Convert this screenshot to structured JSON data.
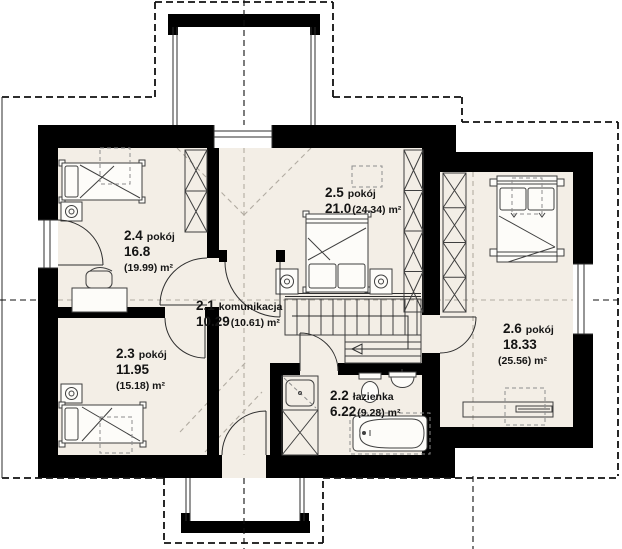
{
  "plan": {
    "floor_name": "",
    "unit": "m²"
  },
  "rooms": [
    {
      "id": "2.1",
      "name": "komunikacja",
      "area": "10.29",
      "area_gross": "(10.61) m²"
    },
    {
      "id": "2.2",
      "name": "łazienka",
      "area": "6.22",
      "area_gross": "(9.28) m²"
    },
    {
      "id": "2.3",
      "name": "pokój",
      "area": "11.95",
      "area_gross": "(15.18) m²"
    },
    {
      "id": "2.4",
      "name": "pokój",
      "area": "16.8",
      "area_gross": "(19.99) m²"
    },
    {
      "id": "2.5",
      "name": "pokój",
      "area": "21.0",
      "area_gross": "(24.34) m²"
    },
    {
      "id": "2.6",
      "name": "pokój",
      "area": "18.33",
      "area_gross": "(25.56) m²"
    }
  ],
  "colors": {
    "wall": "#000000",
    "floor": "#f3eee6",
    "line": "#3f3f3f"
  }
}
